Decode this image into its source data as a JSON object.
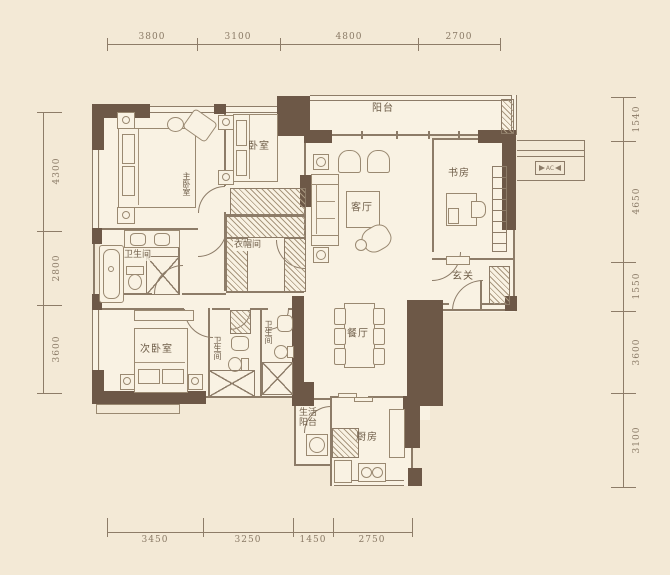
{
  "colors": {
    "background": "#f3e9d6",
    "room_fill": "#f9f2e3",
    "wall": "#6d5847",
    "line": "#8d7c68",
    "text": "#6f5e49",
    "dim_text": "#8a7a66"
  },
  "dimensions": {
    "top": [
      "3800",
      "3100",
      "4800",
      "2700"
    ],
    "bottom": [
      "3450",
      "3250",
      "1450",
      "2750"
    ],
    "left": [
      "4300",
      "2800",
      "3600"
    ],
    "right": [
      "1540",
      "4650",
      "1550",
      "3600",
      "3100"
    ]
  },
  "rooms": {
    "master_bedroom": "主卧室",
    "bedroom": "卧室",
    "balcony": "阳台",
    "living_room": "客厅",
    "study": "书房",
    "foyer": "玄关",
    "dining_room": "餐厅",
    "walk_in_closet": "衣帽间",
    "bathroom_master": "卫生间",
    "bathroom_2": "卫生间",
    "bathroom_3": "卫生间",
    "bedroom_second": "次卧室",
    "kitchen": "厨房",
    "service_balcony": "生活阳台",
    "ac_label": "AC"
  }
}
